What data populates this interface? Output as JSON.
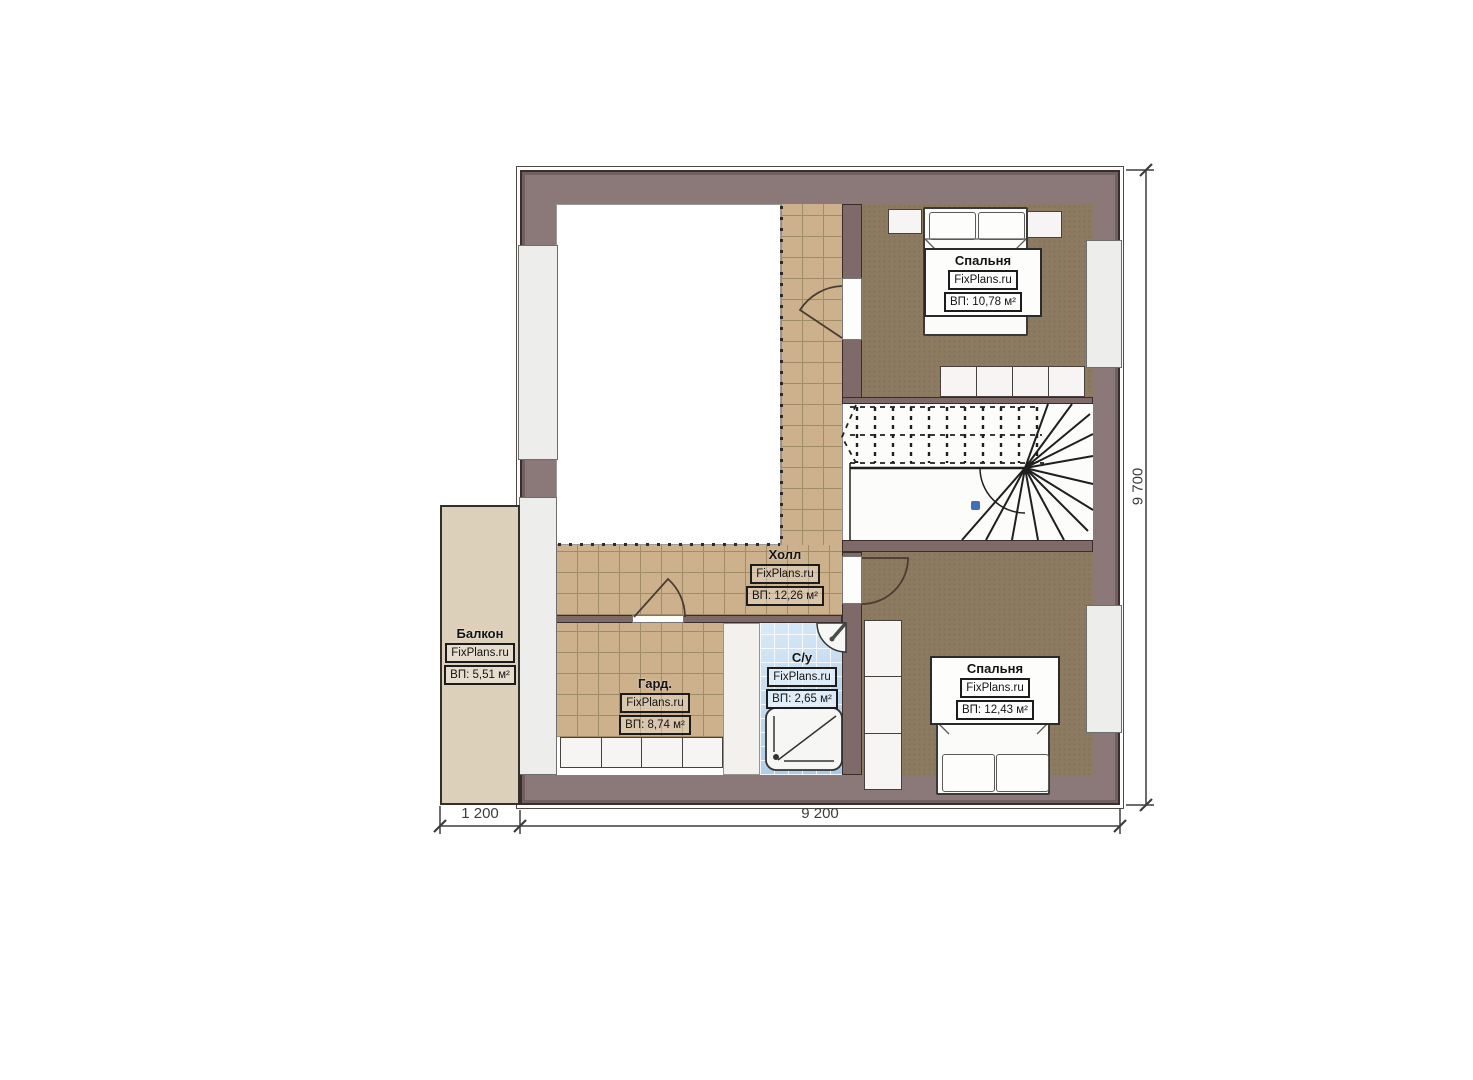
{
  "labels": {
    "bedroom1": {
      "name": "Спальня",
      "brand": "FixPlans.ru",
      "area": "ВП: 10,78 м²"
    },
    "bedroom2": {
      "name": "Спальня",
      "brand": "FixPlans.ru",
      "area": "ВП: 12,43 м²"
    },
    "hall": {
      "name": "Холл",
      "brand": "FixPlans.ru",
      "area": "ВП: 12,26 м²"
    },
    "wardrobe": {
      "name": "Гард.",
      "brand": "FixPlans.ru",
      "area": "ВП: 8,74 м²"
    },
    "bathroom": {
      "name": "С/у",
      "brand": "FixPlans.ru",
      "area": "ВП: 2,65 м²"
    },
    "balcony": {
      "name": "Балкон",
      "brand": "FixPlans.ru",
      "area": "ВП: 5,51 м²"
    }
  },
  "dimensions": {
    "balcony_width": "1 200",
    "house_width": "9 200",
    "house_depth": "9 700"
  },
  "colors": {
    "wall_outer": "#8b7878",
    "wall_partition": "#7e6b69",
    "wall_edge": "#3a2e2b",
    "tile_floor": "#ccb18c",
    "tile_line": "#a08c67",
    "carpet": "#8c7b61",
    "bath_tile_light": "#d9eaf8",
    "bath_tile_dark": "#a8c8e2",
    "balcony_floor": "#ddd0bb",
    "window_fill": "#ededeb",
    "stair_marker": "#3f6dc0",
    "dim_color": "#3d3d3d",
    "label_ink": "#141414"
  }
}
